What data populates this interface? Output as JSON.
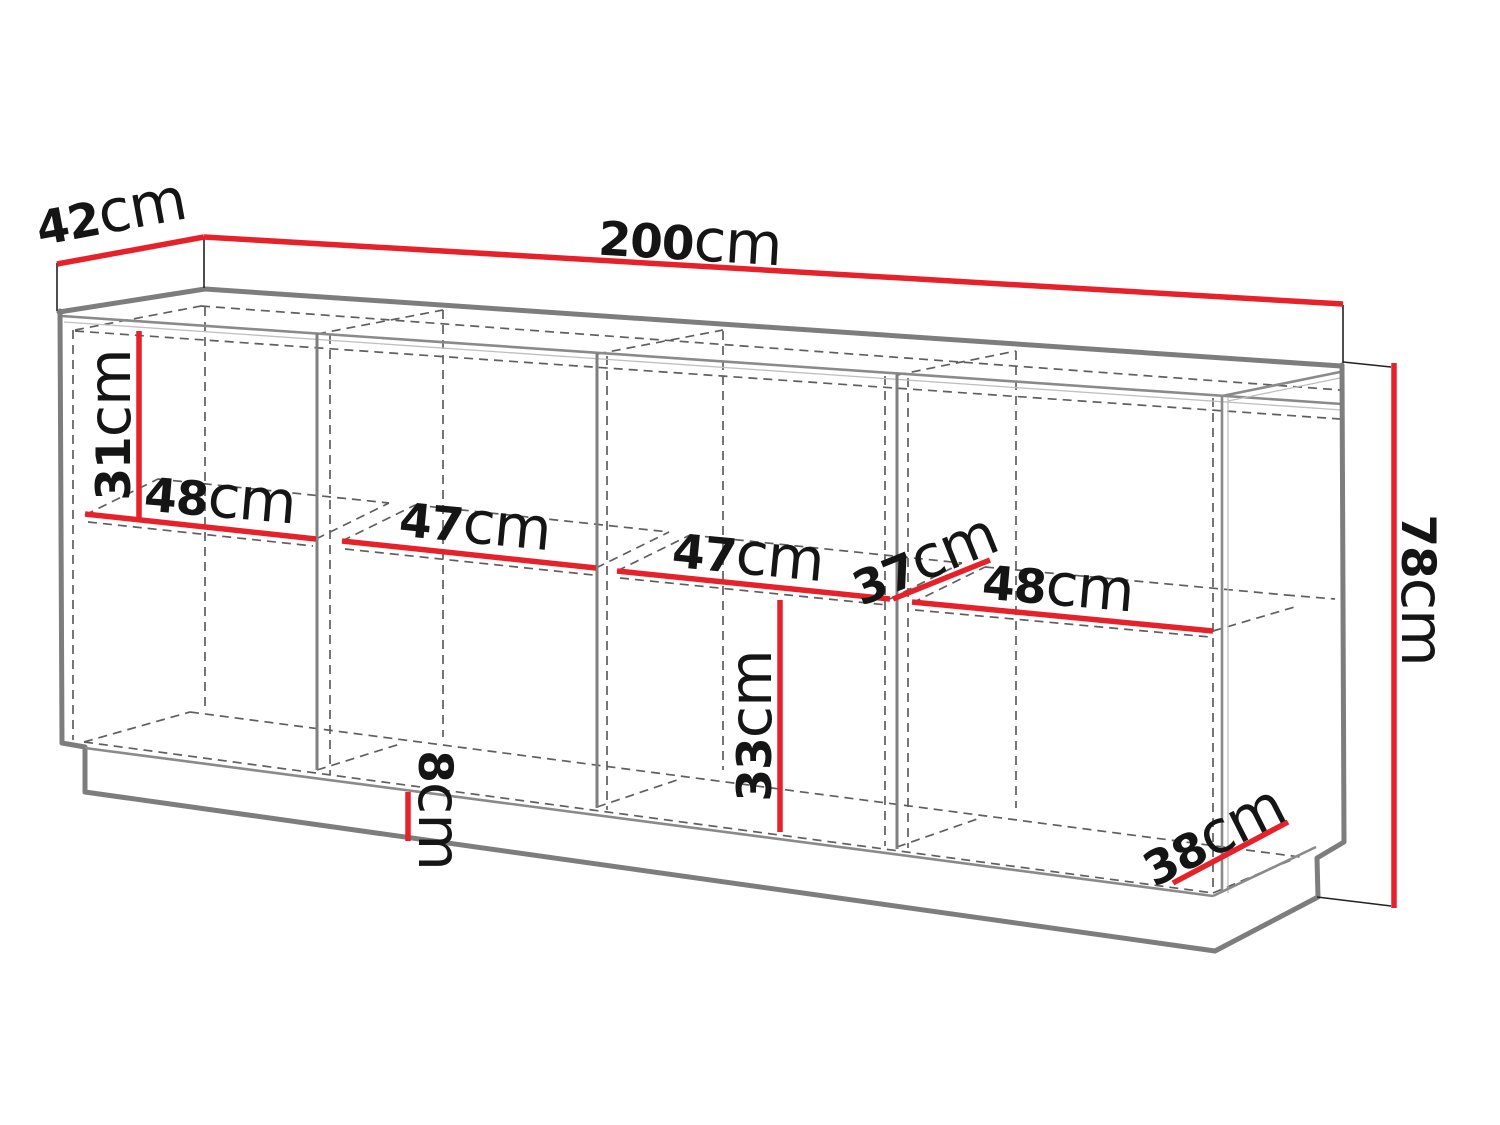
{
  "diagram": {
    "title": "sideboard-dimension-diagram",
    "unit": "cm",
    "colors": {
      "dimension_line": "#e62129",
      "outline": "#7d7d7d",
      "label_text": "#151515",
      "background": "#ffffff"
    },
    "dimensions": {
      "depth_top": {
        "value": "42",
        "unit": "cm"
      },
      "width_total": {
        "value": "200",
        "unit": "cm"
      },
      "height_total": {
        "value": "78",
        "unit": "cm"
      },
      "upper_section_height": {
        "value": "31",
        "unit": "cm"
      },
      "compartment1_width": {
        "value": "48",
        "unit": "cm"
      },
      "compartment2_width": {
        "value": "47",
        "unit": "cm"
      },
      "compartment3_width": {
        "value": "47",
        "unit": "cm"
      },
      "shelf_depth": {
        "value": "37",
        "unit": "cm"
      },
      "compartment4_width": {
        "value": "48",
        "unit": "cm"
      },
      "lower_section_height": {
        "value": "33",
        "unit": "cm"
      },
      "plinth_height": {
        "value": "8",
        "unit": "cm"
      },
      "depth_bottom": {
        "value": "38",
        "unit": "cm"
      }
    }
  }
}
